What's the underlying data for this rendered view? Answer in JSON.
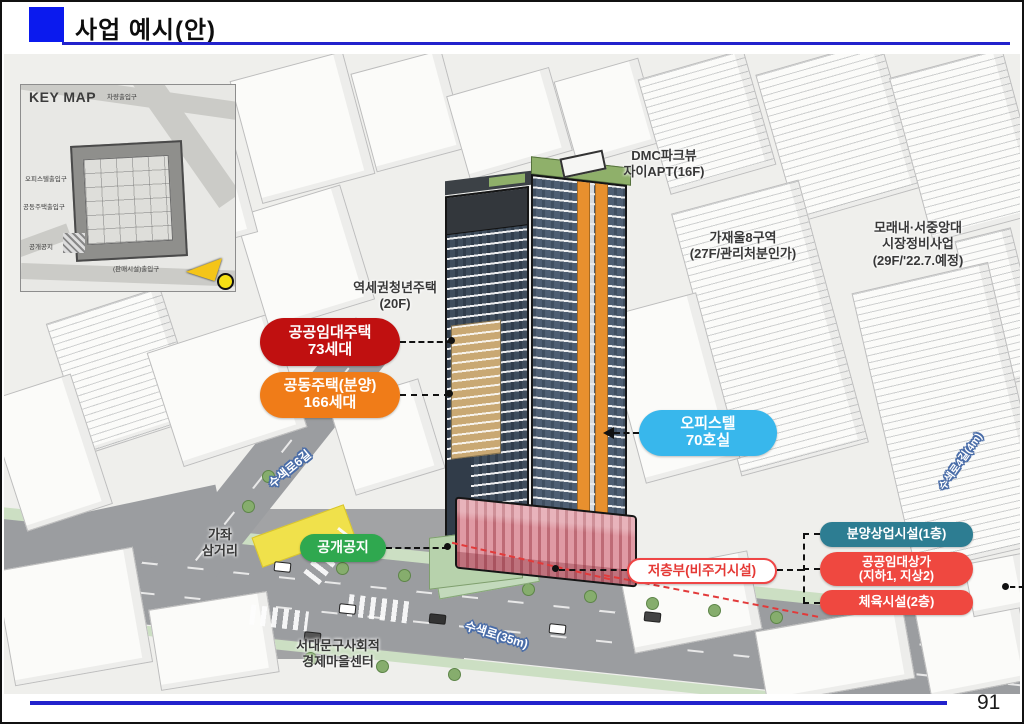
{
  "slide": {
    "title": "사업 예시(안)",
    "page_number": "91"
  },
  "keymap": {
    "title": "KEY MAP",
    "labels": [
      "차량출입구",
      "오피스텔출입구",
      "공동주택출입구",
      "공개공지",
      "(판매시설)출입구"
    ]
  },
  "context_labels": {
    "dmc_parkview": "DMC파크뷰\n자이APT(16F)",
    "gajaeul_district8": "가재울8구역\n(27F/관리처분인가)",
    "moraenae_market": "모래내·서중앙대\n시장정비사업\n(29F/'22.7.예정)",
    "station_youth_housing": "역세권청년주택\n(20F)",
    "gajwa_intersection": "가좌\n삼거리",
    "seodaemun_center": "서대문구사회적\n경제마을센터"
  },
  "callouts": {
    "public_rental_housing": {
      "label": "공공임대주택\n73세대",
      "color": "#c01010"
    },
    "apartments_for_sale": {
      "label": "공동주택(분양)\n166세대",
      "color": "#f07c18"
    },
    "officetel": {
      "label": "오피스텔\n70호실",
      "color": "#38b7ec"
    },
    "open_space": {
      "label": "공개공지",
      "color": "#2fa84f"
    },
    "lower_levels": {
      "label": "저층부(비주거시설)",
      "color": "#e8403a"
    },
    "commercial_sale": {
      "label": "분양상업시설(1층)",
      "color": "#2d7d92"
    },
    "public_rental_shops": {
      "label": "공공임대상가\n(지하1, 지상2)",
      "color": "#ef4840"
    },
    "sports_facility": {
      "label": "체육시설(2층)",
      "color": "#ef4840"
    }
  },
  "street_labels": {
    "susaekro6gil": "수색로6길",
    "susaekro": "수색로(35m)",
    "susaekro4gil": "수색로4길(4m)"
  },
  "colors": {
    "title_accent": "#0b1aee",
    "rule_blue": "#2222cc",
    "tower_glass": "#4e5e72",
    "tower_orange": "#e8902e",
    "tower_tan": "#c9a873",
    "podium_pink": "#e09aa4",
    "roof_green": "#8fb06a"
  }
}
